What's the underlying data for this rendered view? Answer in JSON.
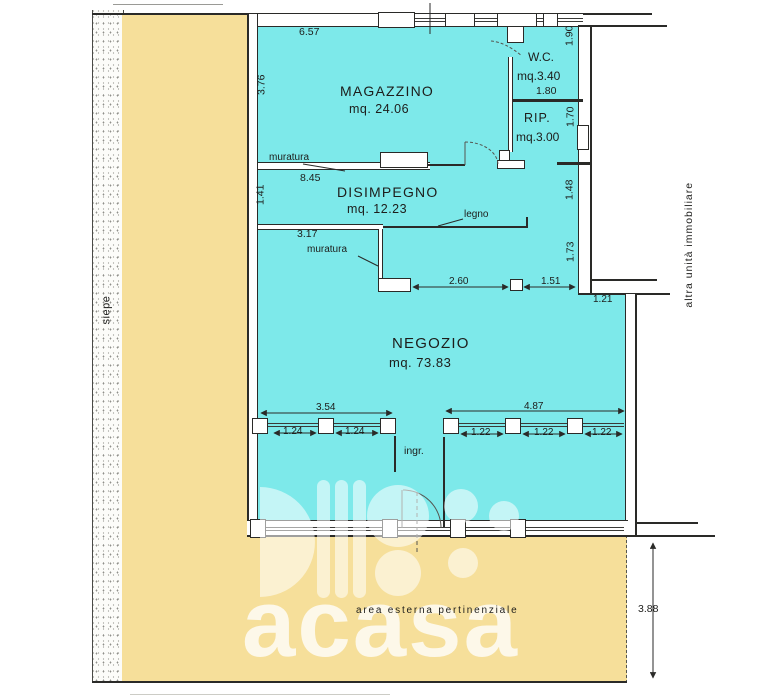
{
  "document": {
    "type": "planimetria catastale",
    "unit_note": "measurements in metres, areas in mq"
  },
  "rooms": {
    "magazzino": {
      "name": "MAGAZZINO",
      "area": "mq. 24.06"
    },
    "wc": {
      "name": "W.C.",
      "area": "mq.3.40",
      "width": "1.80"
    },
    "rip": {
      "name": "RIP.",
      "area": "mq.3.00"
    },
    "disimpegno": {
      "name": "DISIMPEGNO",
      "area": "mq. 12.23"
    },
    "negozio": {
      "name": "NEGOZIO",
      "area": "mq. 73.83"
    }
  },
  "dimensions": {
    "top_width": "6.57",
    "magazzino_left": "3.76",
    "wc_right": "1.90",
    "rip_right": "1.70",
    "disimpegno_width": "8.45",
    "disimpegno_left": "1.41",
    "disimpegno_right": "1.48",
    "legno_left": "3.17",
    "right_mid": "1.73",
    "opening_a": "2.60",
    "opening_b": "1.51",
    "right_ext": "1.21",
    "band_left": "3.54",
    "band_right": "4.87",
    "win_left": [
      "1.24",
      "1.24"
    ],
    "win_right": [
      "1.22",
      "1.22",
      "1.22"
    ],
    "external_depth": "3.88"
  },
  "labels": {
    "muratura_top": "muratura",
    "muratura_mid": "muratura",
    "legno": "legno",
    "ingresso": "ingr.",
    "siepe": "siepe",
    "altra_unita": "altra unità immobiliare",
    "area_esterna": "area esterna pertinenziale"
  },
  "watermark": {
    "brand": "acasa"
  },
  "colors": {
    "floor": "#7de9ea",
    "external": "#f6df9a",
    "wall": "#2a2a28",
    "hedge_strip": "#fcfcf9"
  }
}
